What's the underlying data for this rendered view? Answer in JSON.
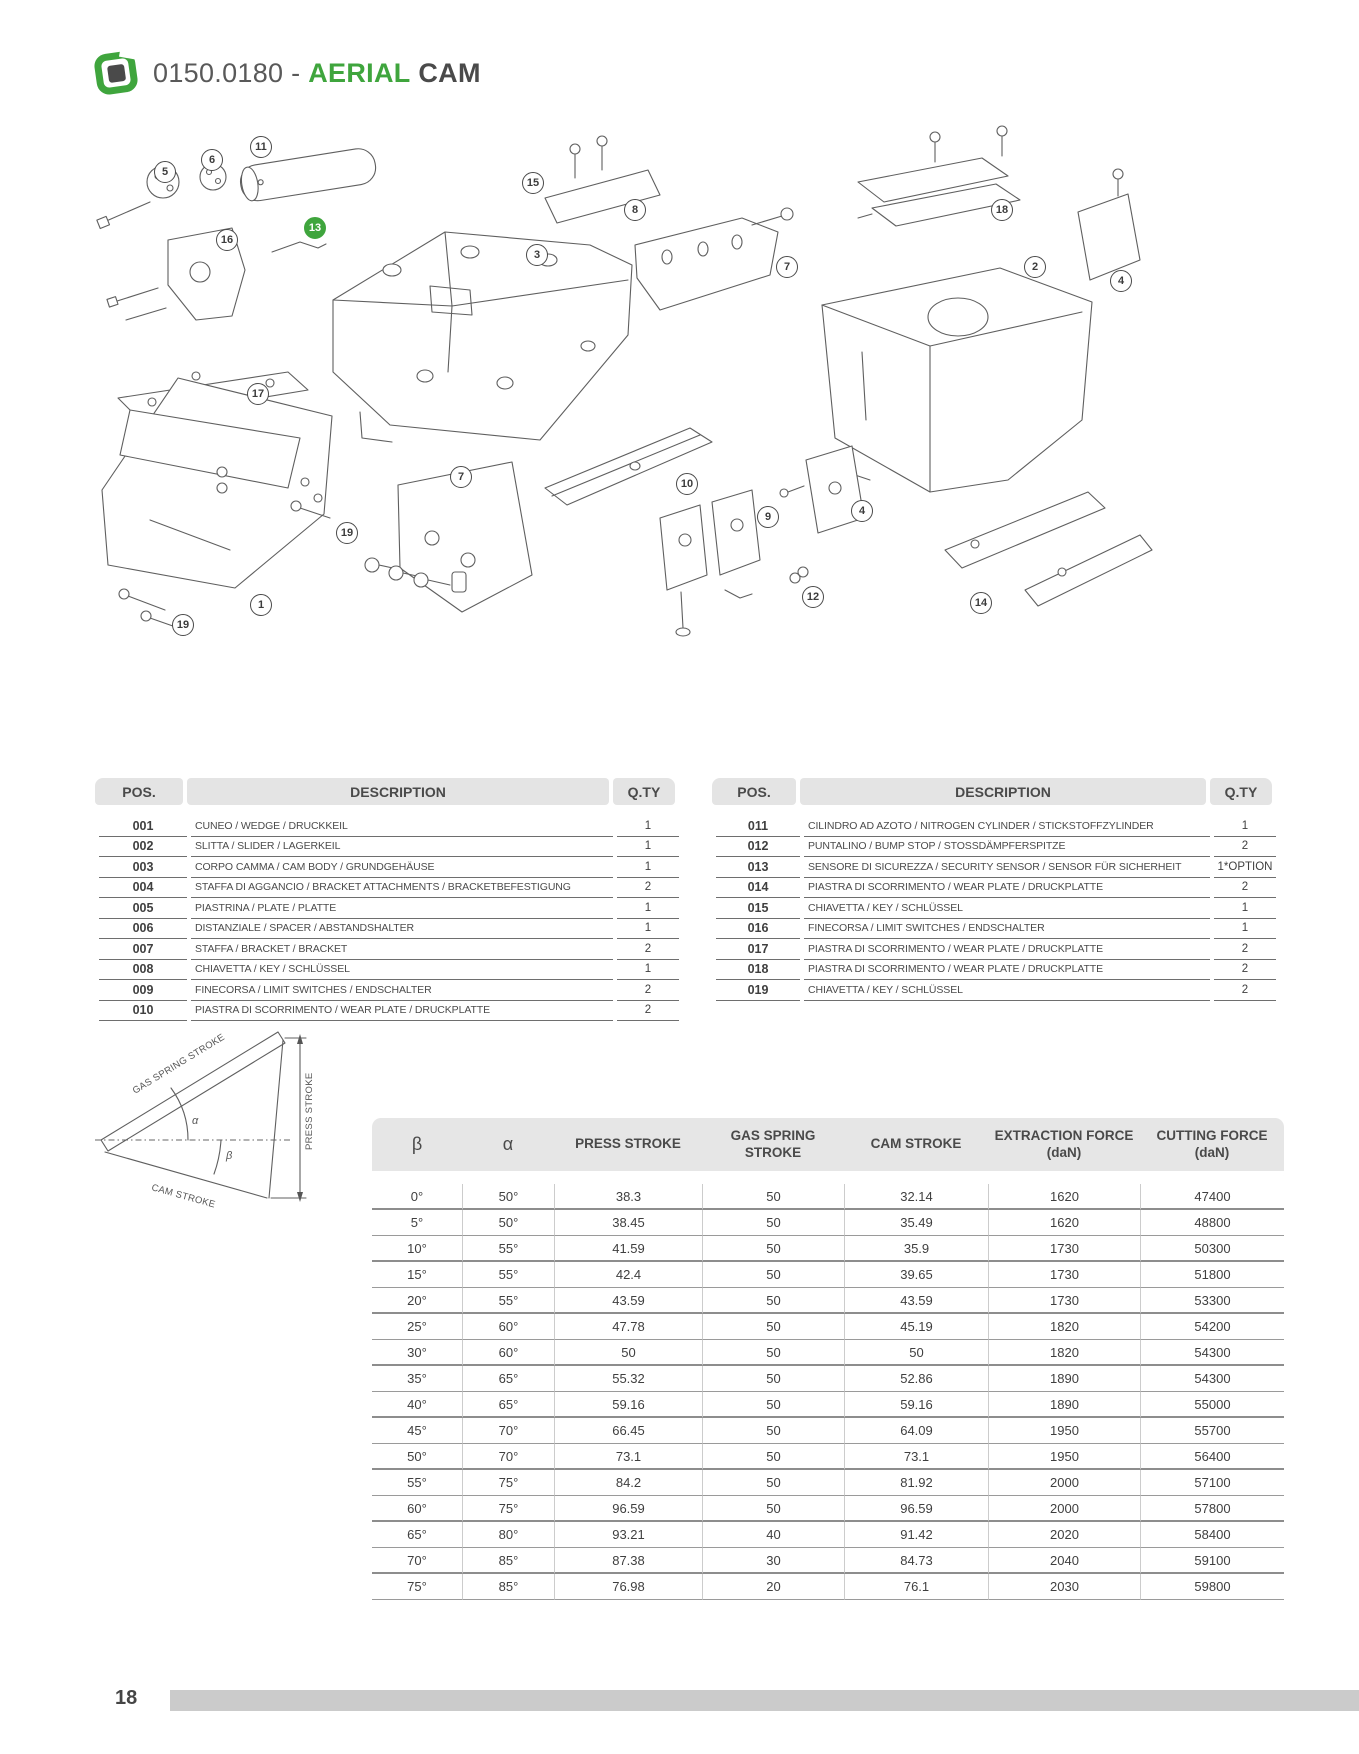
{
  "header": {
    "code": "0150.0180 -",
    "title_accent": "AERIAL",
    "title_rest": "CAM"
  },
  "colors": {
    "accent_green": "#3FA53D",
    "dark_text": "#4a4a4a",
    "table_header_bg": "#E4E4E4",
    "footer_bar": "#CBCBCB"
  },
  "diagram": {
    "callouts": [
      {
        "label": "5",
        "x": 165,
        "y": 172
      },
      {
        "label": "6",
        "x": 212,
        "y": 160
      },
      {
        "label": "11",
        "x": 261,
        "y": 147
      },
      {
        "label": "15",
        "x": 533,
        "y": 183
      },
      {
        "label": "8",
        "x": 635,
        "y": 210
      },
      {
        "label": "18",
        "x": 1002,
        "y": 210
      },
      {
        "label": "13",
        "x": 315,
        "y": 228,
        "highlight": true
      },
      {
        "label": "16",
        "x": 227,
        "y": 240
      },
      {
        "label": "3",
        "x": 537,
        "y": 255
      },
      {
        "label": "7",
        "x": 787,
        "y": 267
      },
      {
        "label": "2",
        "x": 1035,
        "y": 267
      },
      {
        "label": "4",
        "x": 1121,
        "y": 281
      },
      {
        "label": "17",
        "x": 258,
        "y": 394
      },
      {
        "label": "7",
        "x": 461,
        "y": 477
      },
      {
        "label": "10",
        "x": 687,
        "y": 484
      },
      {
        "label": "9",
        "x": 768,
        "y": 517
      },
      {
        "label": "4",
        "x": 862,
        "y": 511
      },
      {
        "label": "19",
        "x": 347,
        "y": 533
      },
      {
        "label": "12",
        "x": 813,
        "y": 597
      },
      {
        "label": "14",
        "x": 981,
        "y": 603
      },
      {
        "label": "19",
        "x": 183,
        "y": 625
      },
      {
        "label": "1",
        "x": 261,
        "y": 605
      }
    ]
  },
  "parts": {
    "pos_header": "POS.",
    "description_header": "DESCRIPTION",
    "qty_header": "Q.TY",
    "left_rows": [
      {
        "pos": "001",
        "desc": "CUNEO / WEDGE / DRUCKKEIL",
        "qty": "1"
      },
      {
        "pos": "002",
        "desc": "SLITTA / SLIDER / LAGERKEIL",
        "qty": "1"
      },
      {
        "pos": "003",
        "desc": "CORPO CAMMA / CAM BODY / GRUNDGEHÄUSE",
        "qty": "1"
      },
      {
        "pos": "004",
        "desc": "STAFFA DI AGGANCIO / BRACKET ATTACHMENTS / BRACKETBEFESTIGUNG",
        "qty": "2"
      },
      {
        "pos": "005",
        "desc": "PIASTRINA / PLATE / PLATTE",
        "qty": "1"
      },
      {
        "pos": "006",
        "desc": "DISTANZIALE / SPACER / ABSTANDSHALTER",
        "qty": "1"
      },
      {
        "pos": "007",
        "desc": "STAFFA / BRACKET / BRACKET",
        "qty": "2"
      },
      {
        "pos": "008",
        "desc": "CHIAVETTA / KEY / SCHLÜSSEL",
        "qty": "1"
      },
      {
        "pos": "009",
        "desc": "FINECORSA / LIMIT SWITCHES / ENDSCHALTER",
        "qty": "2"
      },
      {
        "pos": "010",
        "desc": "PIASTRA DI SCORRIMENTO  /  WEAR PLATE /  DRUCKPLATTE",
        "qty": "2"
      }
    ],
    "right_rows": [
      {
        "pos": "011",
        "desc": "CILINDRO AD AZOTO / NITROGEN CYLINDER / STICKSTOFFZYLINDER",
        "qty": "1"
      },
      {
        "pos": "012",
        "desc": "PUNTALINO / BUMP STOP /  STOSSDÄMPFERSPITZE",
        "qty": "2"
      },
      {
        "pos": "013",
        "desc": "SENSORE DI SICUREZZA / SECURITY SENSOR / SENSOR FÜR SICHERHEIT",
        "qty": "1*OPTION"
      },
      {
        "pos": "014",
        "desc": "PIASTRA DI SCORRIMENTO  /  WEAR PLATE /  DRUCKPLATTE",
        "qty": "2"
      },
      {
        "pos": "015",
        "desc": "CHIAVETTA / KEY / SCHLÜSSEL",
        "qty": "1"
      },
      {
        "pos": "016",
        "desc": "FINECORSA / LIMIT SWITCHES / ENDSCHALTER",
        "qty": "1"
      },
      {
        "pos": "017",
        "desc": "PIASTRA DI SCORRIMENTO  /  WEAR PLATE /  DRUCKPLATTE",
        "qty": "2"
      },
      {
        "pos": "018",
        "desc": "PIASTRA DI SCORRIMENTO  /  WEAR PLATE /  DRUCKPLATTE",
        "qty": "2"
      },
      {
        "pos": "019",
        "desc": "CHIAVETTA / KEY / SCHLÜSSEL",
        "qty": "2"
      }
    ]
  },
  "stroke_diagram": {
    "gas_label": "GAS SPRING STROKE",
    "press_label": "PRESS STROKE",
    "cam_label": "CAM STROKE",
    "alpha": "α",
    "beta": "β"
  },
  "force_table": {
    "columns": [
      "β",
      "α",
      "PRESS STROKE",
      "GAS SPRING STROKE",
      "CAM STROKE",
      "EXTRACTION FORCE (daN)",
      "CUTTING FORCE (daN)"
    ],
    "rows": [
      [
        "0°",
        "50°",
        "38.3",
        "50",
        "32.14",
        "1620",
        "47400"
      ],
      [
        "5°",
        "50°",
        "38.45",
        "50",
        "35.49",
        "1620",
        "48800"
      ],
      [
        "10°",
        "55°",
        "41.59",
        "50",
        "35.9",
        "1730",
        "50300"
      ],
      [
        "15°",
        "55°",
        "42.4",
        "50",
        "39.65",
        "1730",
        "51800"
      ],
      [
        "20°",
        "55°",
        "43.59",
        "50",
        "43.59",
        "1730",
        "53300"
      ],
      [
        "25°",
        "60°",
        "47.78",
        "50",
        "45.19",
        "1820",
        "54200"
      ],
      [
        "30°",
        "60°",
        "50",
        "50",
        "50",
        "1820",
        "54300"
      ],
      [
        "35°",
        "65°",
        "55.32",
        "50",
        "52.86",
        "1890",
        "54300"
      ],
      [
        "40°",
        "65°",
        "59.16",
        "50",
        "59.16",
        "1890",
        "55000"
      ],
      [
        "45°",
        "70°",
        "66.45",
        "50",
        "64.09",
        "1950",
        "55700"
      ],
      [
        "50°",
        "70°",
        "73.1",
        "50",
        "73.1",
        "1950",
        "56400"
      ],
      [
        "55°",
        "75°",
        "84.2",
        "50",
        "81.92",
        "2000",
        "57100"
      ],
      [
        "60°",
        "75°",
        "96.59",
        "50",
        "96.59",
        "2000",
        "57800"
      ],
      [
        "65°",
        "80°",
        "93.21",
        "40",
        "91.42",
        "2020",
        "58400"
      ],
      [
        "70°",
        "85°",
        "87.38",
        "30",
        "84.73",
        "2040",
        "59100"
      ],
      [
        "75°",
        "85°",
        "76.98",
        "20",
        "76.1",
        "2030",
        "59800"
      ]
    ]
  },
  "footer": {
    "page_number": "18"
  }
}
